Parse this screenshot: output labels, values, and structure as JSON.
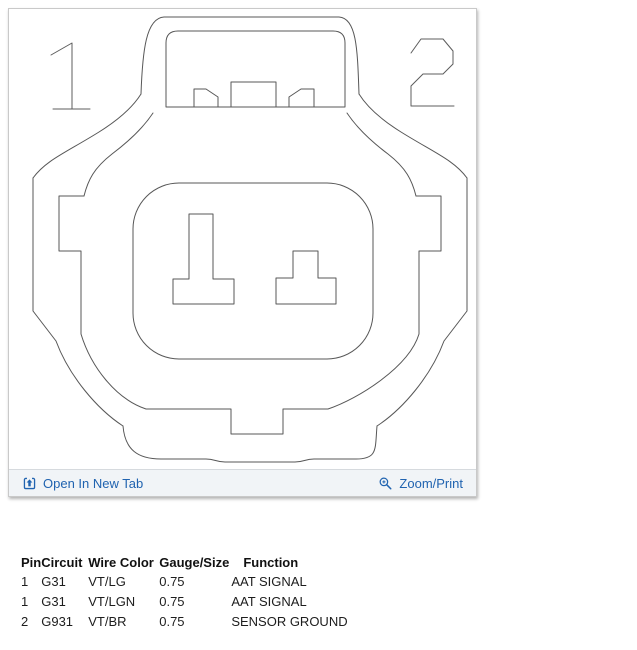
{
  "viewer": {
    "toolbar": {
      "open_in_new_tab_label": "Open In New Tab",
      "zoom_print_label": "Zoom/Print",
      "link_color": "#2063b0",
      "background": "#f1f4f7"
    },
    "diagram": {
      "pin_labels": [
        "1",
        "2"
      ],
      "line_color": "#575757"
    },
    "icons": {
      "open_in_new_tab": "open-in-new-tab-icon",
      "zoom_print": "magnifier-plus-icon"
    }
  },
  "pinout_table": {
    "headers": [
      "Pin",
      "Circuit",
      "Wire Color",
      "Gauge/Size",
      "Function"
    ],
    "rows": [
      [
        "1",
        "G31",
        "VT/LG",
        "0.75",
        "AAT SIGNAL"
      ],
      [
        "1",
        "G31",
        "VT/LGN",
        "0.75",
        "AAT SIGNAL"
      ],
      [
        "2",
        "G931",
        "VT/BR",
        "0.75",
        "SENSOR GROUND"
      ]
    ]
  }
}
